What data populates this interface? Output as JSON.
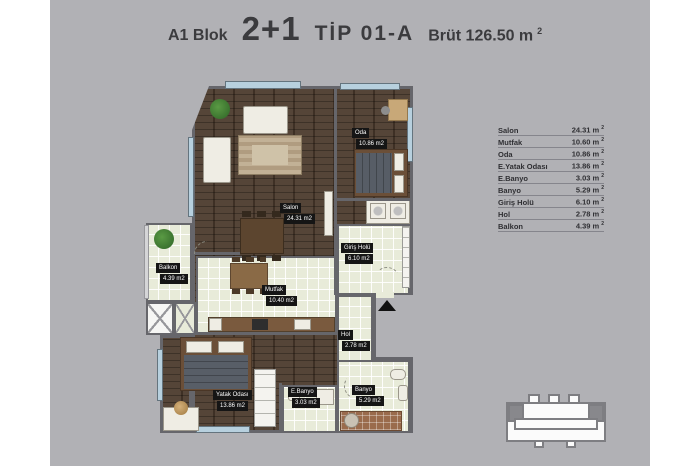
{
  "title": {
    "block": "A1 Blok",
    "plan_type": "2+1",
    "tip": "TİP 01-A",
    "gross": "Brüt 126.50 m",
    "gross_sup": "2"
  },
  "legend": {
    "rows": [
      {
        "label": "Salon",
        "value": "24.31 m",
        "sup": "2"
      },
      {
        "label": "Mutfak",
        "value": "10.60 m",
        "sup": "2"
      },
      {
        "label": "Oda",
        "value": "10.86 m",
        "sup": "2"
      },
      {
        "label": "E.Yatak Odası",
        "value": "13.86 m",
        "sup": "2"
      },
      {
        "label": "E.Banyo",
        "value": "3.03 m",
        "sup": "2"
      },
      {
        "label": "Banyo",
        "value": "5.29 m",
        "sup": "2"
      },
      {
        "label": "Giriş Holü",
        "value": "6.10 m",
        "sup": "2"
      },
      {
        "label": "Hol",
        "value": "2.78 m",
        "sup": "2"
      },
      {
        "label": "Balkon",
        "value": "4.39 m",
        "sup": "2"
      }
    ]
  },
  "plan": {
    "badges": [
      {
        "name": "Salon",
        "area": "24.31 m2"
      },
      {
        "name": "Oda",
        "area": "10.86 m2"
      },
      {
        "name": "Mutfak",
        "area": "10.40 m2"
      },
      {
        "name": "Giriş Holü",
        "area": "6.10 m2"
      },
      {
        "name": "Hol",
        "area": "2.78 m2"
      },
      {
        "name": "Balkon",
        "area": "4.39 m2"
      },
      {
        "name": "Yatak Odası",
        "area": "13.86 m2"
      },
      {
        "name": "E.Banyo",
        "area": "3.03 m2"
      },
      {
        "name": "Banyo",
        "area": "5.29 m2"
      }
    ]
  },
  "colors": {
    "canvas": "#b1b1b5",
    "wood": "#4c3b2d",
    "tile": "#e8ebd9",
    "wall": "#66666b",
    "badge_bg": "#151515",
    "badge_text": "#ffffff",
    "window": "#b7d0de",
    "highlight_unit": "#88888c"
  }
}
